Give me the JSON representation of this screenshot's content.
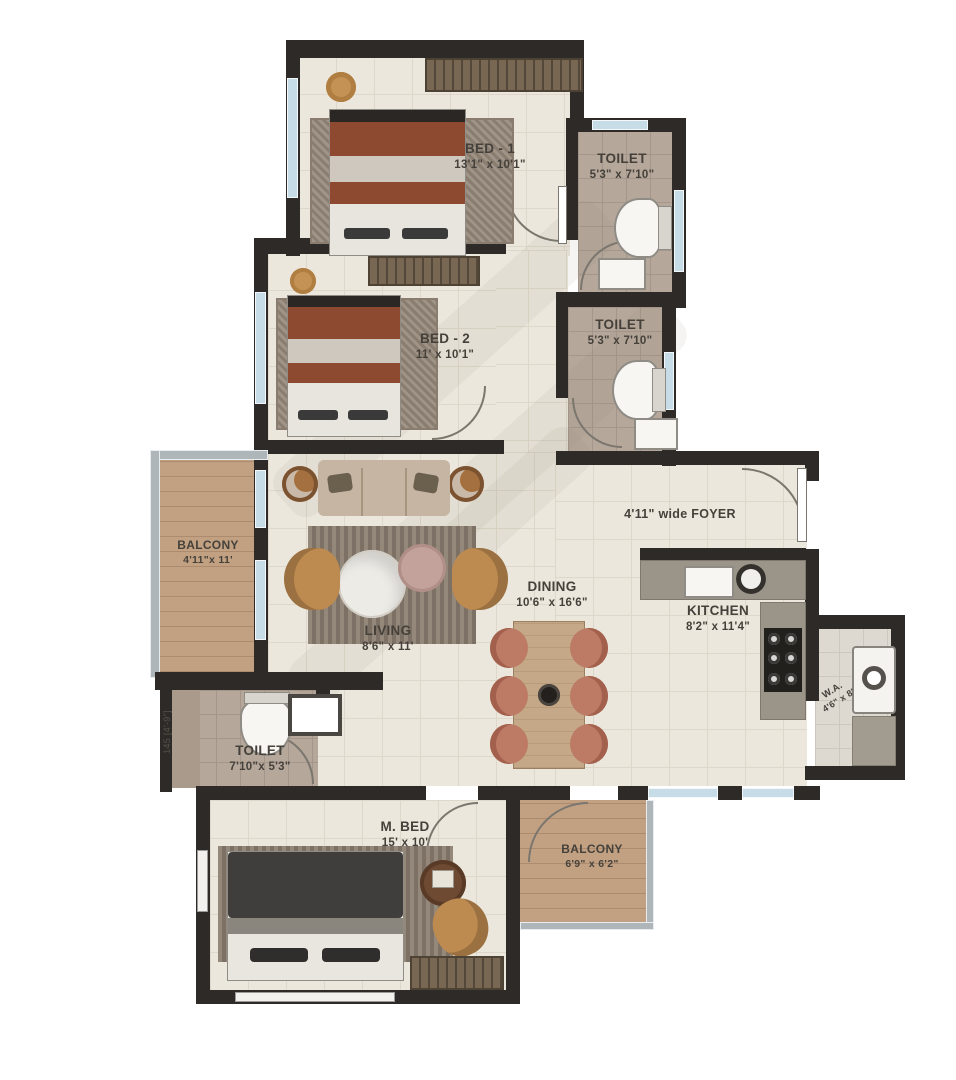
{
  "plan": {
    "type": "apartment-floor-plan",
    "rooms": {
      "bed1": {
        "name": "BED - 1",
        "dims": "13'1\" x 10'1\""
      },
      "toilet1": {
        "name": "TOILET",
        "dims": "5'3\" x 7'10\""
      },
      "bed2": {
        "name": "BED - 2",
        "dims": "11' x 10'1\""
      },
      "toilet2": {
        "name": "TOILET",
        "dims": "5'3\" x 7'10\""
      },
      "balcony_left": {
        "name": "BALCONY",
        "dims": "4'11\"x 11'"
      },
      "foyer": {
        "label": "4'11\" wide FOYER"
      },
      "living": {
        "name": "LIVING",
        "dims": "8'6\" x 11'"
      },
      "dining": {
        "name": "DINING",
        "dims": "10'6\" x 16'6\""
      },
      "kitchen": {
        "name": "KITCHEN",
        "dims": "8'2\" x 11'4\""
      },
      "wa": {
        "name": "W.A.",
        "dims": "4'6\" x 8'"
      },
      "toilet3": {
        "name": "TOILET",
        "dims": "7'10\"x 5'3\""
      },
      "mbed": {
        "name": "M. BED",
        "dims": "15' x 10'"
      },
      "balcony_bottom": {
        "name": "BALCONY",
        "dims": "6'9\" x 6'2\""
      }
    },
    "annotations": {
      "left_wall_dimension": "145 [4'-9\"]"
    },
    "colors": {
      "wall": "#2e2a27",
      "floor_tile": "#ece7dd",
      "toilet_tile": "#b5a79a",
      "wood_deck": "#c2a183",
      "window_glass": "#c6dde8",
      "armchair": "#bd8a50",
      "dining_chair": "#bd7a64",
      "bed1_blanket": "#8e4a31",
      "mbed_blanket": "#3f3e3c",
      "counter": "#9b9489",
      "label_text": "#45413a"
    }
  }
}
